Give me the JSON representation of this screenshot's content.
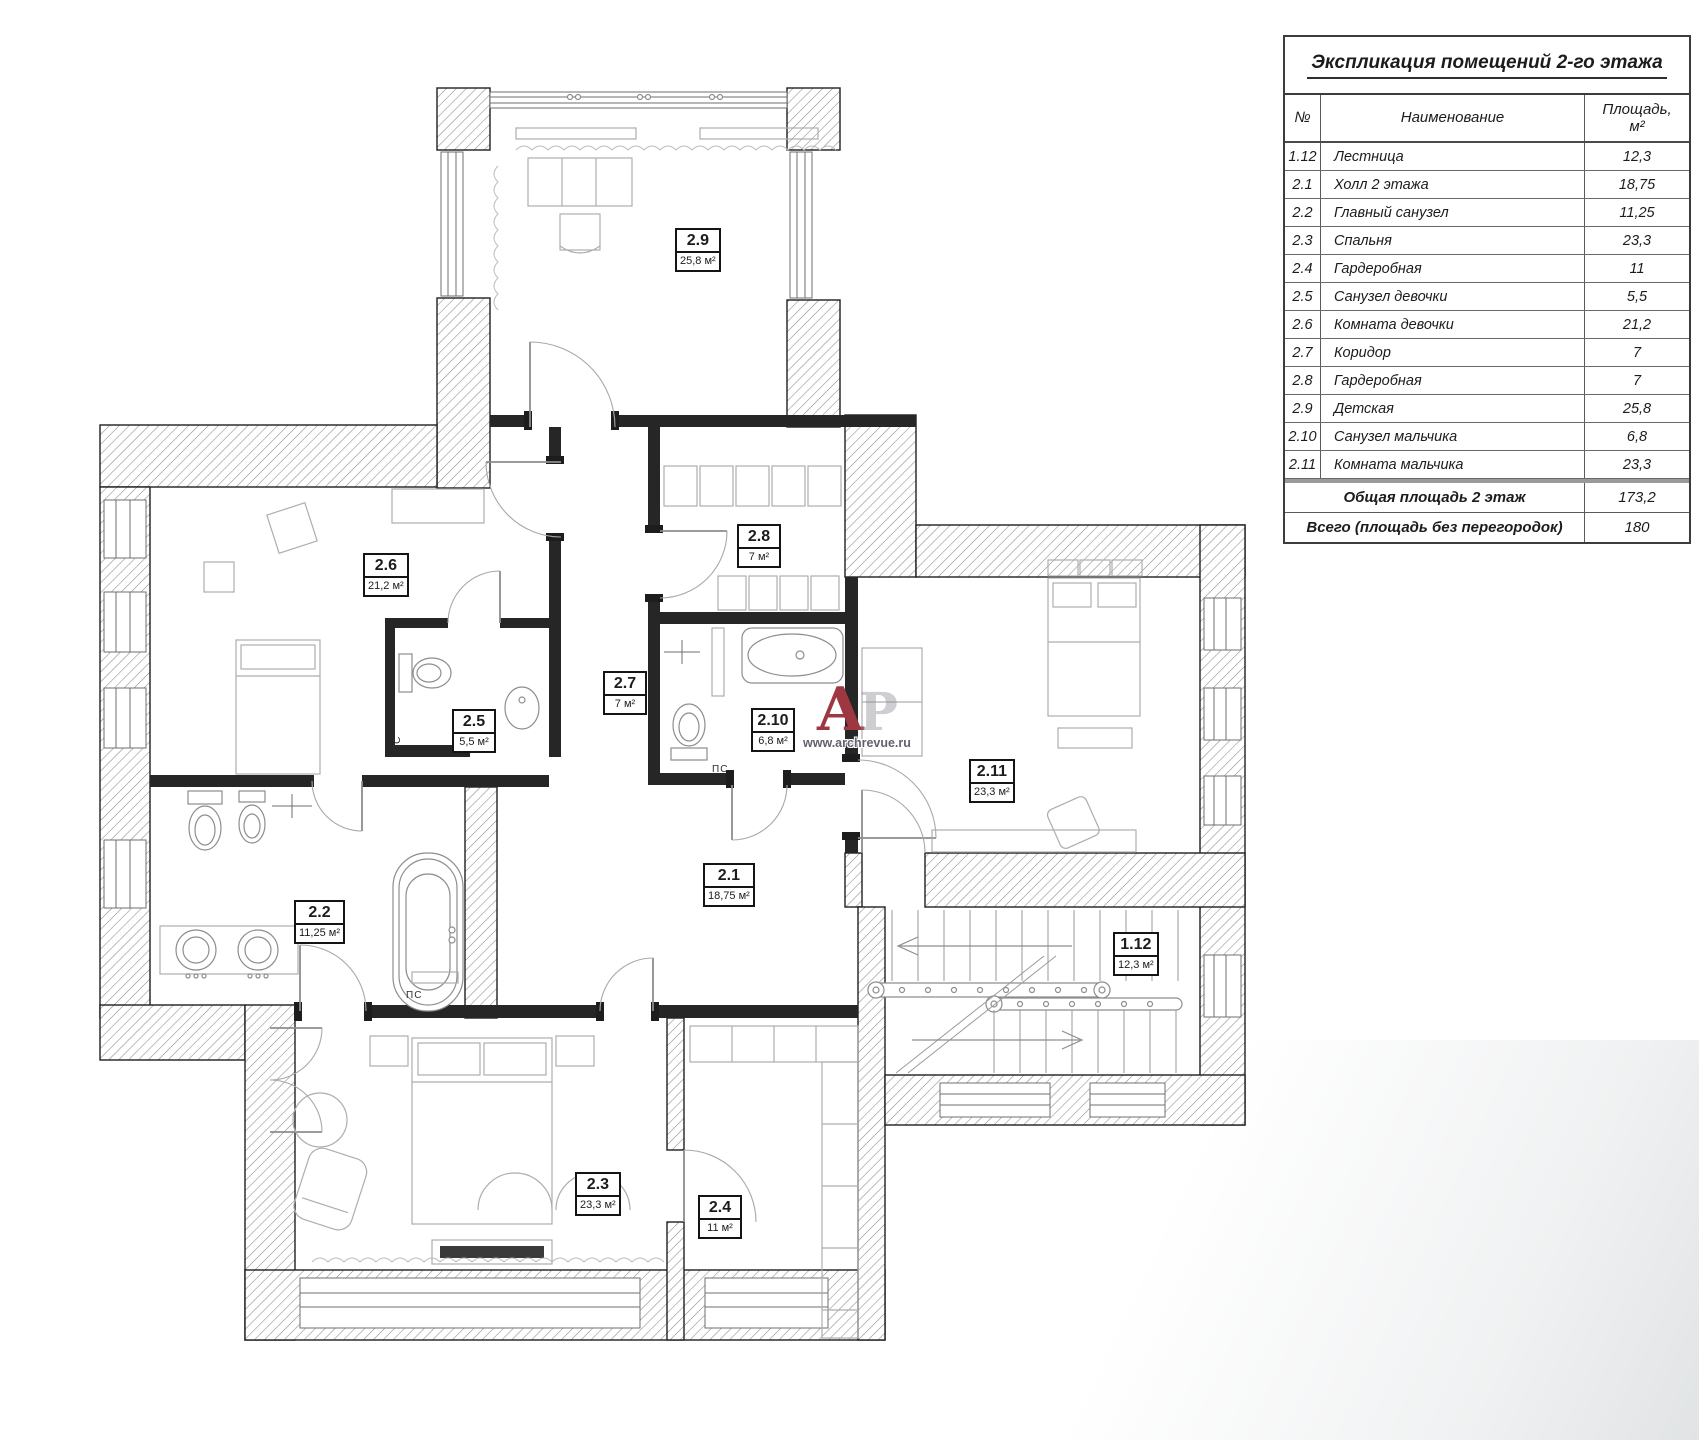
{
  "meta": {
    "background": "#ffffff",
    "line_color": "#1f1f1f",
    "hatch_color": "#8a8a8a",
    "accent_red": "#9d3741",
    "furniture_gray": "#adadad"
  },
  "plan": {
    "ps_label": "ПС",
    "rooms": [
      {
        "id": "2.9",
        "area": "25,8 м²"
      },
      {
        "id": "2.6",
        "area": "21,2 м²"
      },
      {
        "id": "2.8",
        "area": "7 м²"
      },
      {
        "id": "2.7",
        "area": "7 м²"
      },
      {
        "id": "2.5",
        "area": "5,5 м²"
      },
      {
        "id": "2.10",
        "area": "6,8 м²"
      },
      {
        "id": "2.2",
        "area": "11,25 м²"
      },
      {
        "id": "2.1",
        "area": "18,75 м²"
      },
      {
        "id": "2.11",
        "area": "23,3 м²"
      },
      {
        "id": "1.12",
        "area": "12,3 м²"
      },
      {
        "id": "2.3",
        "area": "23,3 м²"
      },
      {
        "id": "2.4",
        "area": "11 м²"
      }
    ]
  },
  "watermark": {
    "logo_primary": "А",
    "logo_secondary": "Р",
    "site": "www.archrevue.ru"
  },
  "table": {
    "title": "Экспликация помещений 2-го этажа",
    "col_no": "№",
    "col_name": "Наименование",
    "col_area_1": "Площадь,",
    "col_area_2": "м²",
    "rows": [
      {
        "no": "1.12",
        "name": "Лестница",
        "area": "12,3"
      },
      {
        "no": "2.1",
        "name": "Холл 2 этажа",
        "area": "18,75"
      },
      {
        "no": "2.2",
        "name": "Главный санузел",
        "area": "11,25"
      },
      {
        "no": "2.3",
        "name": "Спальня",
        "area": "23,3"
      },
      {
        "no": "2.4",
        "name": "Гардеробная",
        "area": "11"
      },
      {
        "no": "2.5",
        "name": "Санузел девочки",
        "area": "5,5"
      },
      {
        "no": "2.6",
        "name": "Комната девочки",
        "area": "21,2"
      },
      {
        "no": "2.7",
        "name": "Коридор",
        "area": "7"
      },
      {
        "no": "2.8",
        "name": "Гардеробная",
        "area": "7"
      },
      {
        "no": "2.9",
        "name": "Детская",
        "area": "25,8"
      },
      {
        "no": "2.10",
        "name": "Санузел мальчика",
        "area": "6,8"
      },
      {
        "no": "2.11",
        "name": "Комната мальчика",
        "area": "23,3"
      }
    ],
    "totals": [
      {
        "label": "Общая площадь 2 этаж",
        "value": "173,2"
      },
      {
        "label": "Всего (площадь без перегородок)",
        "value": "180"
      }
    ]
  }
}
